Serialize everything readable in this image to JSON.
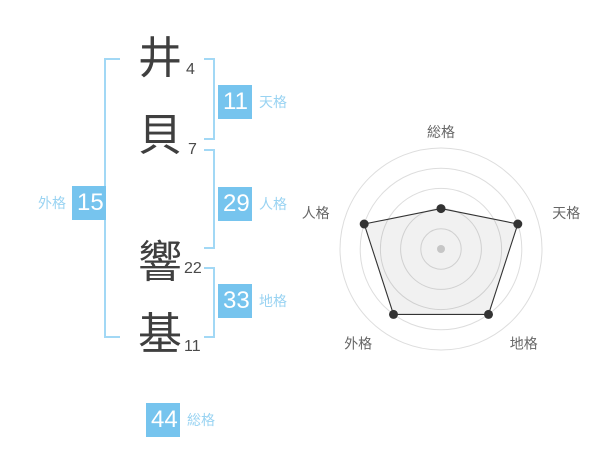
{
  "page": {
    "title": "姓名判断の結果",
    "background": "#ffffff"
  },
  "name": {
    "full": "井貝 響基",
    "chars": [
      {
        "char": "井",
        "strokes": "4",
        "part": "surname"
      },
      {
        "char": "貝",
        "strokes": "7",
        "part": "surname"
      },
      {
        "char": "響",
        "strokes": "22",
        "part": "given"
      },
      {
        "char": "基",
        "strokes": "11",
        "part": "given"
      }
    ]
  },
  "kaku": {
    "tenkaku": {
      "label": "天格",
      "value": "11"
    },
    "jinkaku": {
      "label": "人格",
      "value": "29"
    },
    "chikaku": {
      "label": "地格",
      "value": "33"
    },
    "gaikaku": {
      "label": "外格",
      "value": "15"
    },
    "soukaku": {
      "label": "総格",
      "value": "44"
    }
  },
  "colors": {
    "accent_blue": "#76c4ee",
    "label_blue": "#99d3f2",
    "bracket_blue": "#a2d8f5",
    "kanji_gray": "#3f3f3f",
    "chart_line": "#333333",
    "chart_grid": "#dddddd",
    "chart_fill": "rgba(0,0,0,0.055)",
    "chart_center_dot": "#c6c6c6",
    "chart_label": "#666666"
  },
  "chart_data": {
    "type": "radar",
    "categories": [
      "総格",
      "天格",
      "地格",
      "外格",
      "人格"
    ],
    "values": [
      2,
      4,
      4,
      4,
      4
    ],
    "max": 5,
    "rings": 5,
    "start_angle_deg": 90,
    "direction": "clockwise",
    "grid": "concentric-circles",
    "legend": "none",
    "title": ""
  }
}
